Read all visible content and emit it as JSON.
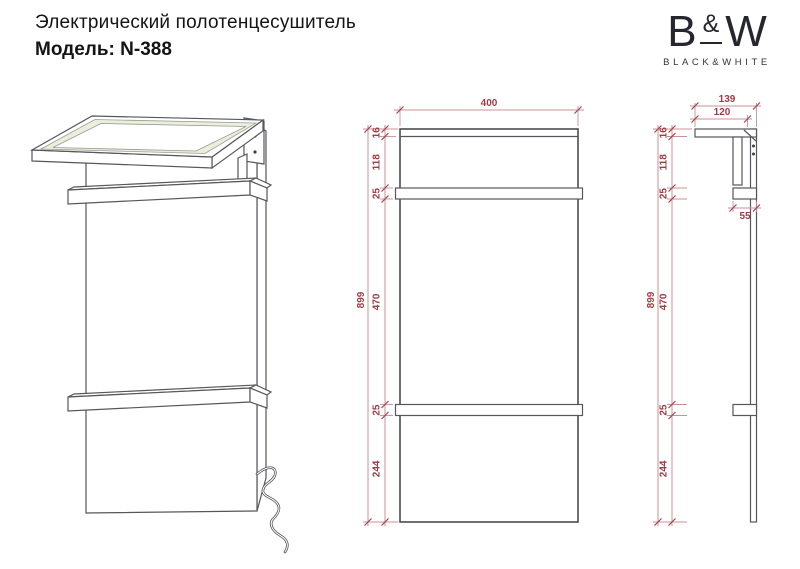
{
  "header": {
    "title": "Электрический полотенцесушитель",
    "model": "Модель: N-388",
    "logo": {
      "letter_b": "B",
      "ampersand": "&",
      "letter_w": "W",
      "subtitle": "BLACK&WHITE"
    }
  },
  "colors": {
    "dimension_line": "#c99296",
    "dimension_text": "#9c3c45",
    "drawing_line": "#56565c",
    "glass_tint": "#e9efdc"
  },
  "views": {
    "front": {
      "width": "400",
      "total_height": "899",
      "segments": [
        "16",
        "118",
        "25",
        "470",
        "25",
        "244"
      ]
    },
    "side": {
      "total_depth": "139",
      "shelf_depth": "120",
      "rail_depth": "55",
      "total_height": "899",
      "segments": [
        "16",
        "118",
        "25",
        "470",
        "25",
        "244"
      ]
    }
  }
}
